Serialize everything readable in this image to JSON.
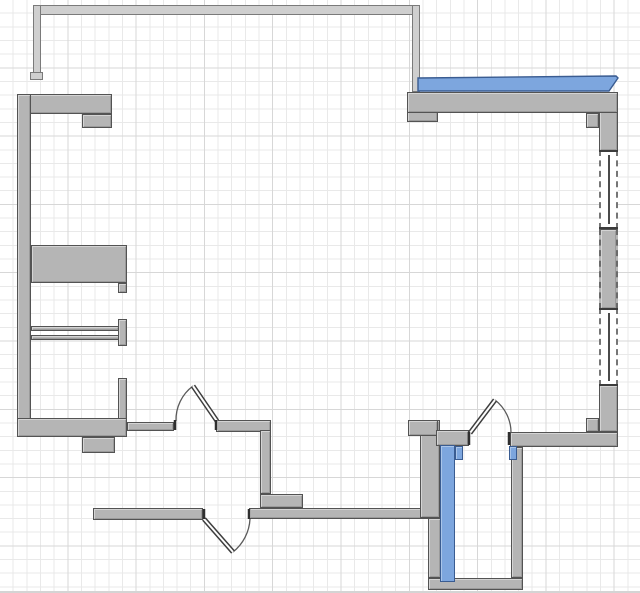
{
  "app": {
    "view": "floor-plan-canvas",
    "visible_text": "",
    "canvas": {
      "width": 640,
      "height": 593
    }
  },
  "colors": {
    "background": "#ffffff",
    "grid_minor": "#e9e9e9",
    "grid_major": "#d7d7d7",
    "wall_fill": "#b5b5b5",
    "wall_border": "#535353",
    "balcony_wall_fill": "#cfcfcf",
    "balcony_wall_border": "#7a7a7a",
    "selected_wall_fill": "#7da6de",
    "selected_wall_border": "#3a5c91",
    "opening_line": "#3d3d3d",
    "window_fill": "#ffffff"
  },
  "floorplan": {
    "balcony_walls": [
      {
        "name": "balcony-wall-top",
        "x": 33,
        "y": 5,
        "w": 387,
        "h": 10
      },
      {
        "name": "balcony-wall-left",
        "x": 33,
        "y": 5,
        "w": 8,
        "h": 74
      },
      {
        "name": "balcony-wall-left-foot",
        "x": 30,
        "y": 72,
        "w": 13,
        "h": 8
      },
      {
        "name": "balcony-wall-right",
        "x": 412,
        "y": 5,
        "w": 8,
        "h": 87
      }
    ],
    "walls": [
      {
        "name": "wall-top-left",
        "x": 17,
        "y": 94,
        "w": 95,
        "h": 20
      },
      {
        "name": "wall-top-left-stub",
        "x": 82,
        "y": 114,
        "w": 30,
        "h": 14
      },
      {
        "name": "wall-left",
        "x": 17,
        "y": 94,
        "w": 14,
        "h": 343
      },
      {
        "name": "wall-mid-thick",
        "x": 31,
        "y": 245,
        "w": 96,
        "h": 38
      },
      {
        "name": "wall-mid-thick-stub",
        "x": 118,
        "y": 283,
        "w": 9,
        "h": 10
      },
      {
        "name": "partition-upper",
        "x": 31,
        "y": 326,
        "w": 88,
        "h": 5
      },
      {
        "name": "partition-lower",
        "x": 31,
        "y": 335,
        "w": 89,
        "h": 5
      },
      {
        "name": "partition-end-cap",
        "x": 118,
        "y": 319,
        "w": 9,
        "h": 27
      },
      {
        "name": "wall-stub-vertical",
        "x": 118,
        "y": 378,
        "w": 9,
        "h": 42
      },
      {
        "name": "wall-bottom-left",
        "x": 17,
        "y": 418,
        "w": 110,
        "h": 19
      },
      {
        "name": "wall-bottom-left-tab",
        "x": 82,
        "y": 437,
        "w": 33,
        "h": 16
      },
      {
        "name": "wall-hall-west",
        "x": 127,
        "y": 422,
        "w": 47,
        "h": 9
      },
      {
        "name": "wall-hall-east",
        "x": 216,
        "y": 420,
        "w": 55,
        "h": 12
      },
      {
        "name": "wall-interior-vertical",
        "x": 260,
        "y": 430,
        "w": 11,
        "h": 64
      },
      {
        "name": "wall-interior-step",
        "x": 260,
        "y": 494,
        "w": 43,
        "h": 14
      },
      {
        "name": "wall-bottom-west",
        "x": 93,
        "y": 508,
        "w": 110,
        "h": 12
      },
      {
        "name": "wall-bottom-mid",
        "x": 249,
        "y": 508,
        "w": 181,
        "h": 11
      },
      {
        "name": "wall-wc-column",
        "x": 420,
        "y": 420,
        "w": 20,
        "h": 98
      },
      {
        "name": "wall-wc-pilaster",
        "x": 408,
        "y": 420,
        "w": 30,
        "h": 16
      },
      {
        "name": "wall-wc-top",
        "x": 436,
        "y": 430,
        "w": 33,
        "h": 16
      },
      {
        "name": "wall-bottom-right",
        "x": 510,
        "y": 432,
        "w": 108,
        "h": 15
      },
      {
        "name": "pilaster-bottom-right",
        "x": 586,
        "y": 418,
        "w": 13,
        "h": 14
      },
      {
        "name": "wall-right-upper",
        "x": 599,
        "y": 110,
        "w": 19,
        "h": 41
      },
      {
        "name": "window-pier",
        "x": 599,
        "y": 229,
        "w": 19,
        "h": 80
      },
      {
        "name": "wall-right-lower",
        "x": 599,
        "y": 385,
        "w": 19,
        "h": 47
      },
      {
        "name": "pilaster-top-right-west",
        "x": 407,
        "y": 92,
        "w": 31,
        "h": 30
      },
      {
        "name": "wall-top-right",
        "x": 407,
        "y": 92,
        "w": 211,
        "h": 21
      },
      {
        "name": "pilaster-top-right-east",
        "x": 586,
        "y": 113,
        "w": 13,
        "h": 15
      },
      {
        "name": "wall-wc-right",
        "x": 511,
        "y": 447,
        "w": 12,
        "h": 131
      },
      {
        "name": "wall-wc-bottom",
        "x": 428,
        "y": 578,
        "w": 95,
        "h": 12
      },
      {
        "name": "wall-wc-left-lower",
        "x": 428,
        "y": 518,
        "w": 13,
        "h": 60
      }
    ],
    "selected_walls": [
      {
        "name": "selected-wall-top-right",
        "box": [
          416,
          74,
          204,
          20
        ],
        "points": "2,4 200,2 202,4 193,17 2,17"
      },
      {
        "name": "selected-wall-wc-left",
        "x": 440,
        "y": 445,
        "w": 15,
        "h": 137
      },
      {
        "name": "selected-wall-stub-west",
        "x": 455,
        "y": 446,
        "w": 8,
        "h": 14
      },
      {
        "name": "selected-wall-stub-east",
        "x": 509,
        "y": 446,
        "w": 8,
        "h": 14
      }
    ],
    "windows": [
      {
        "name": "window-upper",
        "x": 599,
        "y": 150,
        "w": 19,
        "h": 79
      },
      {
        "name": "window-lower",
        "x": 599,
        "y": 308,
        "w": 19,
        "h": 78
      }
    ],
    "doors": [
      {
        "name": "door-hall",
        "box": [
          161,
          374,
          66,
          62
        ],
        "hinge": [
          217,
          421
        ],
        "tip": [
          193,
          386
        ],
        "closed": [
          176,
          421
        ],
        "r": 42,
        "sweep": 0,
        "jambs": [
          [
            175,
            420,
            430
          ],
          [
            216,
            420,
            430
          ]
        ]
      },
      {
        "name": "door-bottom",
        "box": [
          193,
          501,
          65,
          60
        ],
        "hinge": [
          204,
          519
        ],
        "tip": [
          233,
          552
        ],
        "closed": [
          250,
          519
        ],
        "r": 45,
        "sweep": 0,
        "jambs": [
          [
            204,
            509,
            519
          ],
          [
            249,
            509,
            519
          ]
        ]
      },
      {
        "name": "door-wc",
        "box": [
          456,
          386,
          64,
          64
        ],
        "hinge": [
          470,
          433
        ],
        "tip": [
          495,
          400
        ],
        "closed": [
          511,
          433
        ],
        "r": 41,
        "sweep": 1,
        "jambs": [
          [
            469,
            432,
            445
          ],
          [
            509,
            432,
            445
          ]
        ]
      }
    ]
  }
}
